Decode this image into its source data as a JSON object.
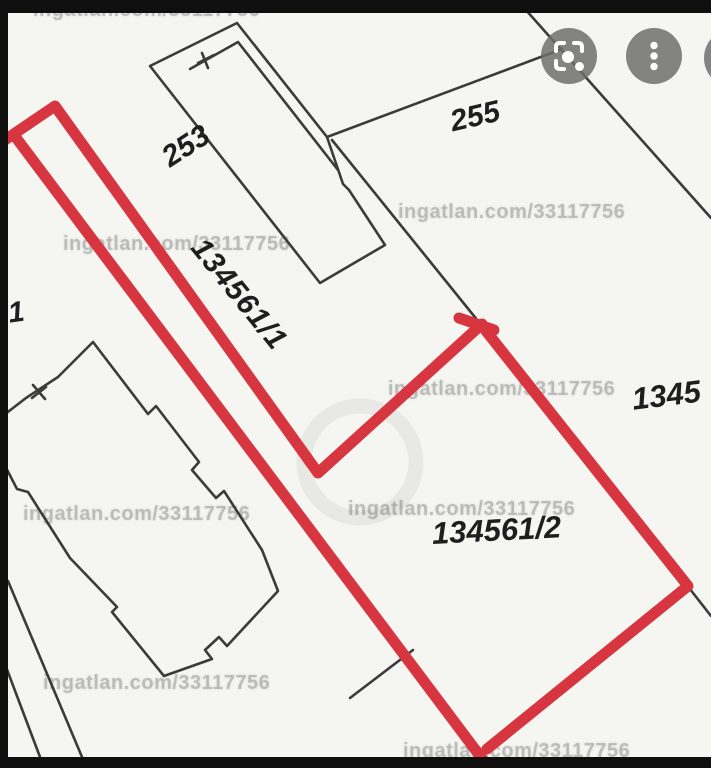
{
  "watermark": {
    "text": "ingatlan.com/33117756"
  },
  "toolbar": {
    "scan_button": {
      "icon": "scan-viewfinder-icon"
    },
    "more_button": {
      "icon": "kebab-menu-icon"
    },
    "partial_button": {
      "icon": "partial-circle-button"
    }
  },
  "map": {
    "description_labels_note": "cadastral parcel numbers visible on map photo",
    "parcel_labels": [
      {
        "text": "253"
      },
      {
        "text": "255"
      },
      {
        "text": "134561/1"
      },
      {
        "text": "134561/2"
      },
      {
        "text": "1345"
      },
      {
        "text": "1"
      }
    ],
    "colors": {
      "highlight_red": "#d7353f",
      "boundary_line": "#3b3b3b",
      "paper": "#f5f5f1",
      "letterbox": "#0f0f0f",
      "button_gray": "#6e6e6e"
    }
  }
}
